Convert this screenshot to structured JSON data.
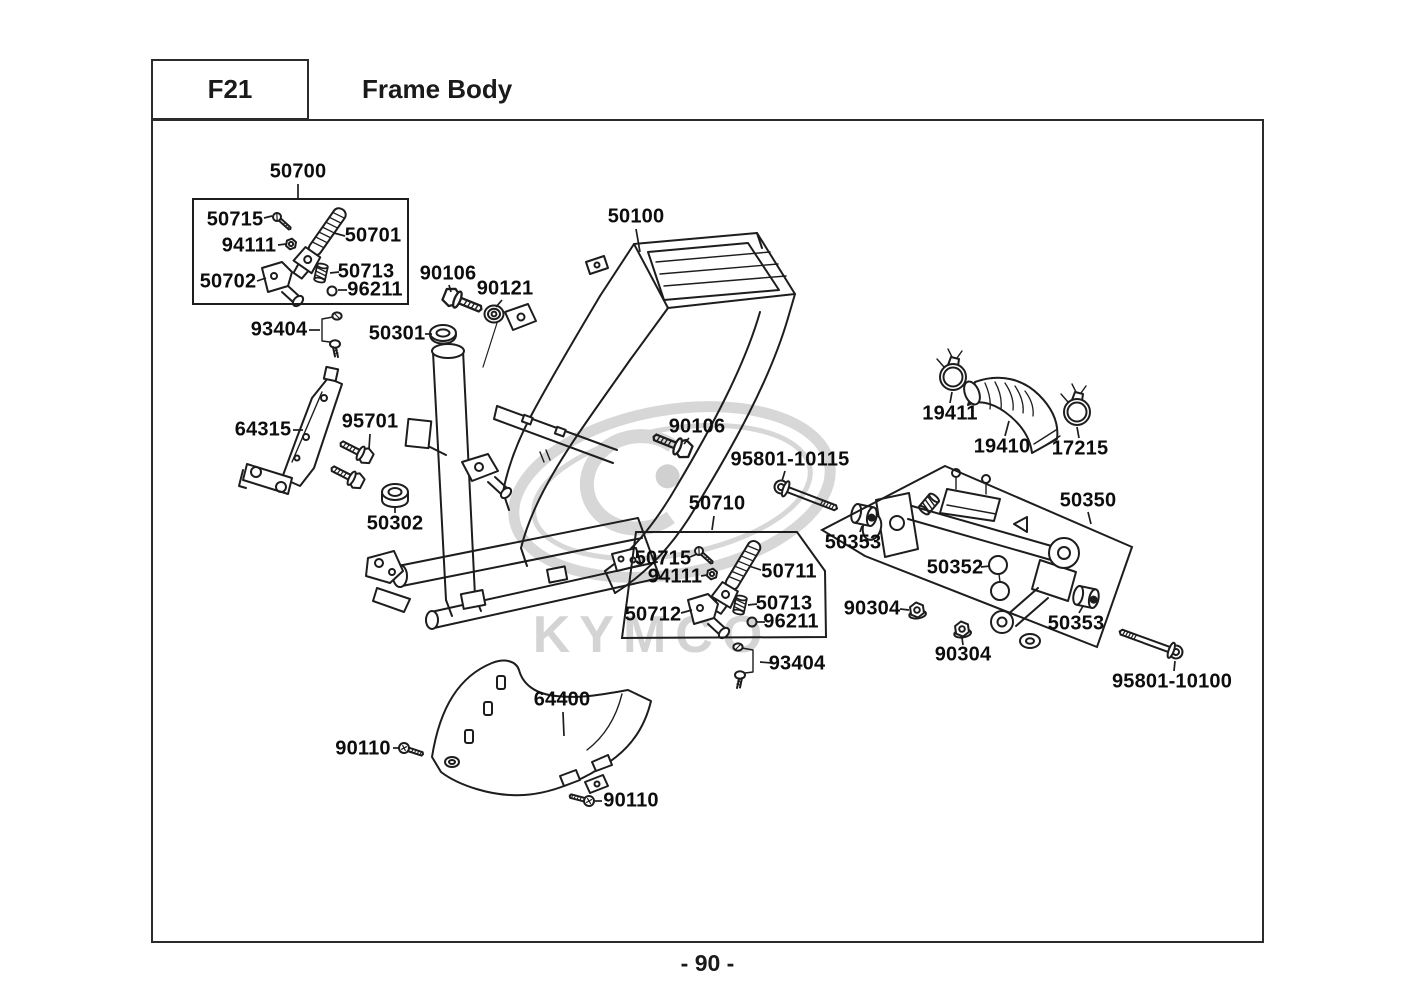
{
  "header": {
    "code": "F21",
    "title": "Frame Body"
  },
  "footer": {
    "page_number": "- 90 -"
  },
  "watermark": {
    "brand": "KYMCO"
  },
  "colors": {
    "line": "#1d1d1d",
    "label_text": "#0d0d0d",
    "border": "#2b2b2b",
    "watermark": "#d7d7d7"
  },
  "diagram": {
    "main_part": "50100",
    "groups": [
      {
        "box": "50700",
        "contains": [
          "50715",
          "94111",
          "50701",
          "50702",
          "50713",
          "96211"
        ]
      },
      {
        "box": "50710",
        "contains": [
          "50715",
          "94111",
          "50711",
          "50712",
          "50713",
          "96211"
        ]
      },
      {
        "box": "50350",
        "contains": [
          "50353",
          "50352",
          "50353"
        ]
      }
    ],
    "labels": [
      {
        "text": "50700",
        "x": 298,
        "y": 172,
        "leader": [
          [
            298,
            184
          ],
          [
            298,
            198
          ]
        ]
      },
      {
        "text": "50715",
        "x": 235,
        "y": 220,
        "leader": [
          [
            264,
            218
          ],
          [
            272,
            216
          ]
        ]
      },
      {
        "text": "94111",
        "x": 249,
        "y": 246,
        "leader": [
          [
            278,
            245
          ],
          [
            286,
            244
          ]
        ]
      },
      {
        "text": "50701",
        "x": 373,
        "y": 236,
        "leader": [
          [
            345,
            236
          ],
          [
            334,
            233
          ]
        ]
      },
      {
        "text": "50702",
        "x": 228,
        "y": 282,
        "leader": [
          [
            257,
            281
          ],
          [
            266,
            278
          ]
        ]
      },
      {
        "text": "50713",
        "x": 366,
        "y": 272,
        "leader": [
          [
            339,
            272
          ],
          [
            330,
            273
          ]
        ]
      },
      {
        "text": "96211",
        "x": 375,
        "y": 290,
        "leader": [
          [
            347,
            290
          ],
          [
            338,
            290
          ]
        ]
      },
      {
        "text": "93404",
        "x": 279,
        "y": 330,
        "leader": [
          [
            309,
            330
          ],
          [
            320,
            330
          ]
        ]
      },
      {
        "text": "50301",
        "x": 397,
        "y": 334,
        "leader": [
          [
            425,
            334
          ],
          [
            432,
            334
          ]
        ]
      },
      {
        "text": "90106",
        "x": 448,
        "y": 274,
        "leader": [
          [
            449,
            285
          ],
          [
            451,
            292
          ]
        ]
      },
      {
        "text": "90121",
        "x": 505,
        "y": 289,
        "leader": [
          [
            502,
            300
          ],
          [
            496,
            307
          ]
        ]
      },
      {
        "text": "50100",
        "x": 636,
        "y": 217,
        "leader": [
          [
            636,
            229
          ],
          [
            640,
            252
          ]
        ]
      },
      {
        "text": "64315",
        "x": 263,
        "y": 430,
        "leader": [
          [
            293,
            430
          ],
          [
            303,
            430
          ]
        ]
      },
      {
        "text": "95701",
        "x": 370,
        "y": 422,
        "leader": [
          [
            370,
            434
          ],
          [
            369,
            449
          ]
        ]
      },
      {
        "text": "50302",
        "x": 395,
        "y": 524,
        "leader": [
          [
            395,
            513
          ],
          [
            395,
            506
          ]
        ]
      },
      {
        "text": "90106",
        "x": 697,
        "y": 427,
        "leader": [
          [
            689,
            438
          ],
          [
            684,
            444
          ]
        ]
      },
      {
        "text": "95801-10115",
        "x": 790,
        "y": 460,
        "leader": [
          [
            785,
            471
          ],
          [
            782,
            481
          ]
        ]
      },
      {
        "text": "50710",
        "x": 717,
        "y": 504,
        "leader": [
          [
            714,
            516
          ],
          [
            712,
            530
          ]
        ]
      },
      {
        "text": "50715",
        "x": 663,
        "y": 559,
        "leader": [
          [
            690,
            557
          ],
          [
            697,
            554
          ]
        ]
      },
      {
        "text": "94111",
        "x": 675,
        "y": 577,
        "leader": [
          [
            701,
            576
          ],
          [
            707,
            575
          ]
        ]
      },
      {
        "text": "50711",
        "x": 789,
        "y": 572,
        "leader": [
          [
            761,
            570
          ],
          [
            749,
            566
          ]
        ]
      },
      {
        "text": "50712",
        "x": 653,
        "y": 615,
        "leader": [
          [
            681,
            613
          ],
          [
            692,
            610
          ]
        ]
      },
      {
        "text": "50713",
        "x": 784,
        "y": 604,
        "leader": [
          [
            757,
            604
          ],
          [
            748,
            605
          ]
        ]
      },
      {
        "text": "96211",
        "x": 791,
        "y": 622,
        "leader": [
          [
            765,
            622
          ],
          [
            757,
            622
          ]
        ]
      },
      {
        "text": "93404",
        "x": 797,
        "y": 664,
        "leader": [
          [
            772,
            663
          ],
          [
            760,
            662
          ]
        ]
      },
      {
        "text": "19411",
        "x": 950,
        "y": 414,
        "leader": [
          [
            950,
            403
          ],
          [
            952,
            392
          ]
        ]
      },
      {
        "text": "19410",
        "x": 1002,
        "y": 447,
        "leader": [
          [
            1005,
            436
          ],
          [
            1009,
            421
          ]
        ]
      },
      {
        "text": "17215",
        "x": 1080,
        "y": 449,
        "leader": [
          [
            1079,
            438
          ],
          [
            1077,
            427
          ]
        ]
      },
      {
        "text": "50350",
        "x": 1088,
        "y": 501,
        "leader": [
          [
            1088,
            512
          ],
          [
            1091,
            524
          ]
        ]
      },
      {
        "text": "50353",
        "x": 853,
        "y": 543,
        "leader": [
          [
            860,
            532
          ],
          [
            862,
            526
          ]
        ]
      },
      {
        "text": "50352",
        "x": 955,
        "y": 568,
        "leader": [
          [
            981,
            567
          ],
          [
            990,
            566
          ]
        ]
      },
      {
        "text": "90304",
        "x": 872,
        "y": 609,
        "leader": [
          [
            900,
            609
          ],
          [
            909,
            610
          ]
        ]
      },
      {
        "text": "90304",
        "x": 963,
        "y": 655,
        "leader": [
          [
            963,
            645
          ],
          [
            962,
            638
          ]
        ]
      },
      {
        "text": "50353",
        "x": 1076,
        "y": 624,
        "leader": [
          [
            1079,
            613
          ],
          [
            1083,
            606
          ]
        ]
      },
      {
        "text": "95801-10100",
        "x": 1172,
        "y": 682,
        "leader": [
          [
            1174,
            671
          ],
          [
            1175,
            661
          ]
        ]
      },
      {
        "text": "64400",
        "x": 562,
        "y": 700,
        "leader": [
          [
            563,
            712
          ],
          [
            564,
            736
          ]
        ]
      },
      {
        "text": "90110",
        "x": 363,
        "y": 749,
        "leader": [
          [
            393,
            748
          ],
          [
            399,
            748
          ]
        ]
      },
      {
        "text": "90110",
        "x": 631,
        "y": 801,
        "leader": [
          [
            602,
            801
          ],
          [
            595,
            801
          ]
        ]
      }
    ]
  }
}
